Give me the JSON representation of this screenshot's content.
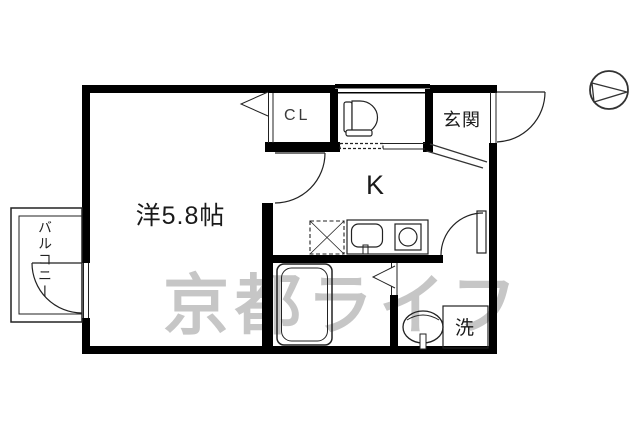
{
  "plan": {
    "title": "apartment-floorplan",
    "rooms": {
      "western_room": {
        "label": "洋5.8帖"
      },
      "closet": {
        "label": "CL"
      },
      "entrance": {
        "label": "玄関"
      },
      "kitchen": {
        "label": "K"
      },
      "laundry": {
        "label": "洗"
      },
      "balcony": {
        "label": "バルコニー"
      }
    },
    "fixtures": [
      "toilet-icon",
      "bathtub-icon",
      "washbasin-icon",
      "kitchen-sink-icon",
      "stove-icon",
      "refrigerator-icon",
      "washer-pan-icon",
      "compass-icon"
    ],
    "watermark": {
      "text": "京都ライフ",
      "color": "#c6c6c6"
    },
    "colors": {
      "wall": "#000000",
      "line": "#222222",
      "background": "#ffffff"
    }
  }
}
